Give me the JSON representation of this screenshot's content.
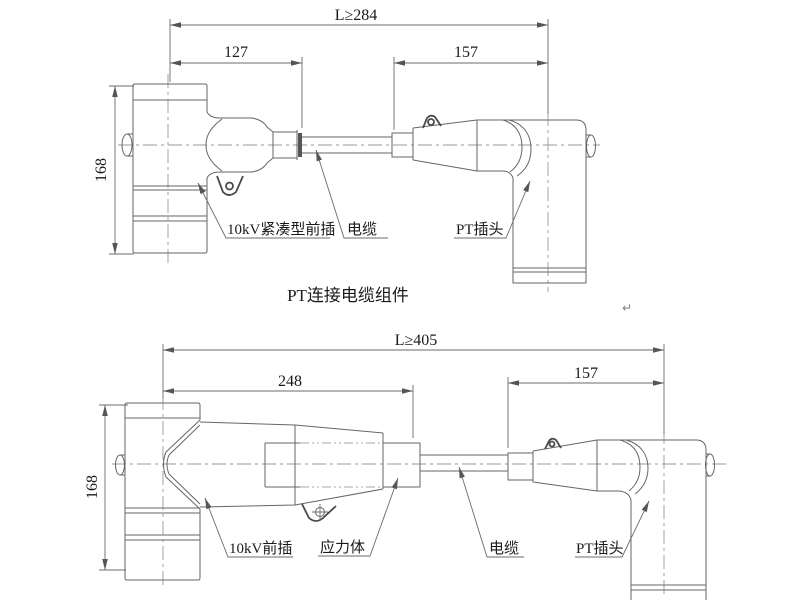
{
  "colors": {
    "line": "#666666",
    "centerline": "#9a9a9a",
    "text": "#1a1a1a",
    "background": "#ffffff"
  },
  "top": {
    "title": "PT连接电缆组件",
    "dims": {
      "overall": "L≥284",
      "front_plug_length": "127",
      "pt_plug_length": "157",
      "height": "168"
    },
    "labels": {
      "front_plug": "10kV紧凑型前插",
      "cable": "电缆",
      "pt_plug": "PT插头"
    }
  },
  "bottom": {
    "dims": {
      "overall": "L≥405",
      "front_plug_length": "248",
      "pt_plug_length": "157",
      "height": "168"
    },
    "labels": {
      "front_plug": "10kV前插",
      "stress_cone": "应力体",
      "cable": "电缆",
      "pt_plug": "PT插头"
    }
  },
  "annotations": {
    "return_mark": "↵"
  }
}
